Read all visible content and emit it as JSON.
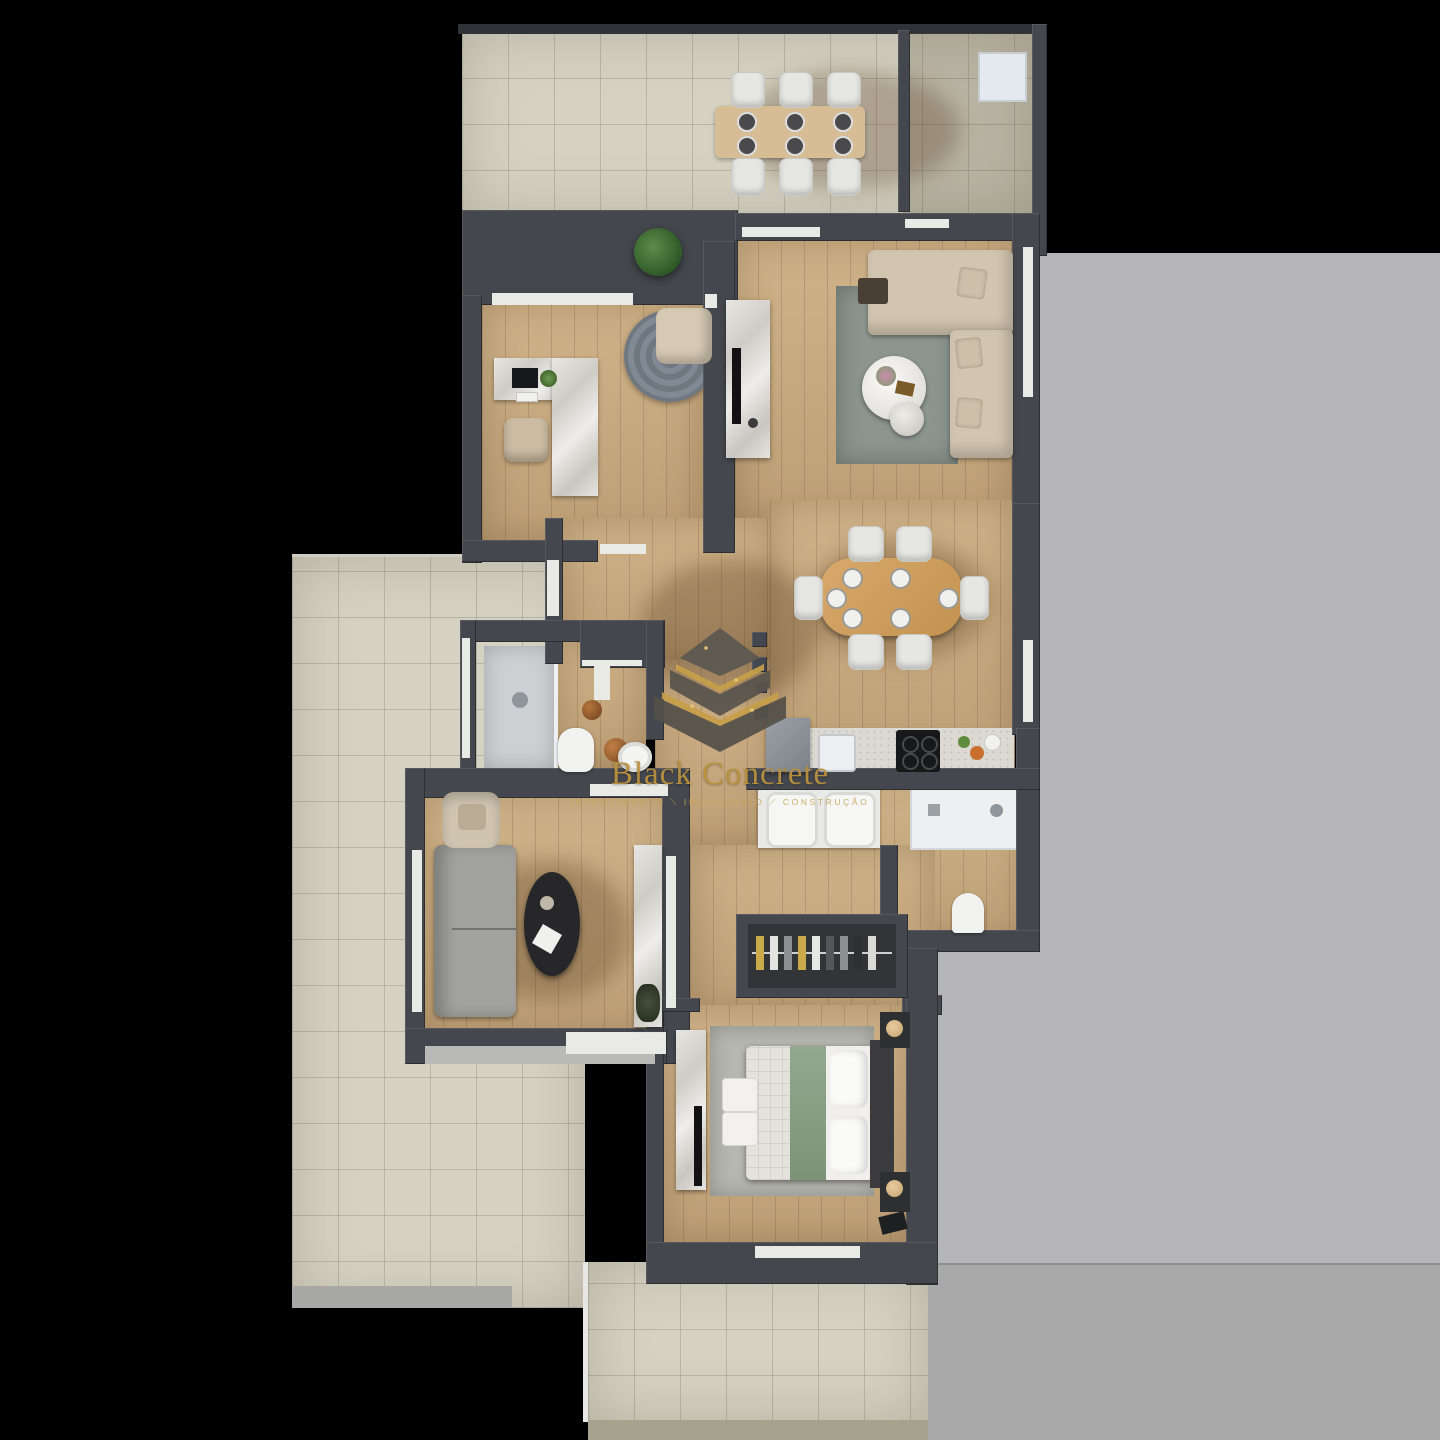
{
  "scene": {
    "description": "3D rendered apartment floor plan, top-down view on black background",
    "background_color": "#000000",
    "side_panel_color": "#b5b5b7",
    "wall_color": "#44474d",
    "wood_floor_color": "#c9ab80",
    "terrace_tile_color": "#d6d2c3"
  },
  "watermark": {
    "logo_icon": "pyramid-logo-icon",
    "title": "Black Concrete",
    "subtitle": "INVESTIMENTO ⟍ IMOBILIÁRIO ⟋ CONSTRUÇÃO",
    "title_color": "#b9913f",
    "gold_color": "#c79f4a"
  },
  "rooms": [
    {
      "name": "top-terrace",
      "features": [
        "outdoor-dining-table",
        "six-chairs",
        "plant",
        "utility-unit"
      ]
    },
    {
      "name": "living-room",
      "features": [
        "l-shaped-sofa",
        "rug",
        "round-coffee-table",
        "tv-console"
      ]
    },
    {
      "name": "office",
      "features": [
        "l-shaped-desk",
        "desk-chair",
        "round-rug",
        "lounge-chair"
      ]
    },
    {
      "name": "dining-room",
      "features": [
        "wood-table",
        "six-chairs",
        "place-settings"
      ]
    },
    {
      "name": "kitchen",
      "features": [
        "fridge",
        "sink",
        "induction-cooktop"
      ]
    },
    {
      "name": "bathroom-1",
      "features": [
        "walk-in-shower",
        "toilet",
        "round-basin",
        "stools"
      ]
    },
    {
      "name": "bathroom-2",
      "features": [
        "shower-tray",
        "double-sink-vanity",
        "toilet"
      ]
    },
    {
      "name": "lounge",
      "features": [
        "gray-sofa",
        "armchair",
        "black-oval-table",
        "marble-console"
      ]
    },
    {
      "name": "hallway",
      "features": [
        "wardrobe-with-clothes"
      ]
    },
    {
      "name": "bedroom",
      "features": [
        "double-bed",
        "green-runner",
        "nightstands",
        "lamps",
        "ottomans",
        "dresser-tv"
      ]
    },
    {
      "name": "left-patio",
      "features": []
    },
    {
      "name": "bottom-terrace",
      "features": []
    }
  ]
}
